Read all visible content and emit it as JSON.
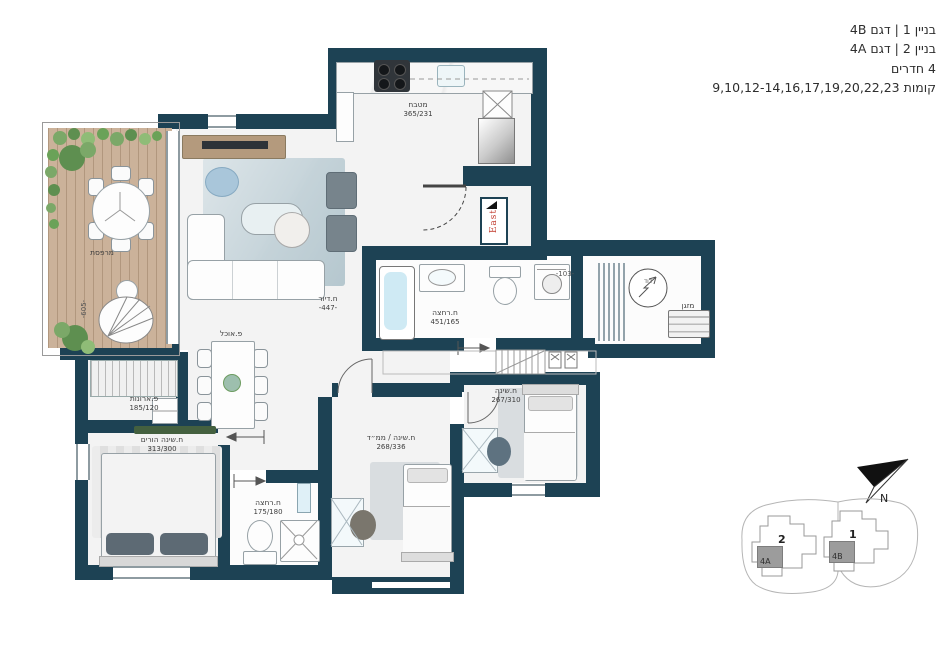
{
  "header": {
    "lines": [
      "בניין 1 | דגם 4B",
      "בניין 2 | דגם 4A",
      "4 חדרים",
      "קומות 9,10,12-14,16,17,19,20,22,23"
    ]
  },
  "plan": {
    "balcony": {
      "name": "מרפסת"
    },
    "living": {
      "name": "ח.דיור",
      "width_dim": "-447-",
      "depth_dim": "-605-"
    },
    "dining": {
      "name": "פ.אוכל"
    },
    "kitchen": {
      "name": "מטבח",
      "size": "365/231"
    },
    "bath_main": {
      "name": "ח.רחצה",
      "size": "451/165"
    },
    "bath_small": {
      "name": "ח.רחצה",
      "size": "175/180"
    },
    "bed_parents": {
      "name": "ח.שינה הורים",
      "size": "313/300"
    },
    "bed_mamad": {
      "name": "ח.שינה / ממ״ד",
      "size": "268/336"
    },
    "bed_right": {
      "name": "ח.שינה",
      "size": "267/310"
    },
    "closet": {
      "name": "פ.ארונות",
      "size": "185/120"
    },
    "ac_unit": {
      "name": "מזגן"
    },
    "boiler": {
      "name": "דוד"
    },
    "entry_dim": "-103-"
  },
  "entrance_logo": {
    "text": "East"
  },
  "site_plan": {
    "building_1": {
      "number": "1",
      "unit": "4B"
    },
    "building_2": {
      "number": "2",
      "unit": "4A"
    },
    "north_label": "N"
  },
  "colors": {
    "wall": "#1d4254",
    "deck": "#cbb29a",
    "accent_red": "#c0392b",
    "water": "#cfeaf4",
    "greenery": "#6d9c61",
    "rug": "#c6d4da"
  }
}
